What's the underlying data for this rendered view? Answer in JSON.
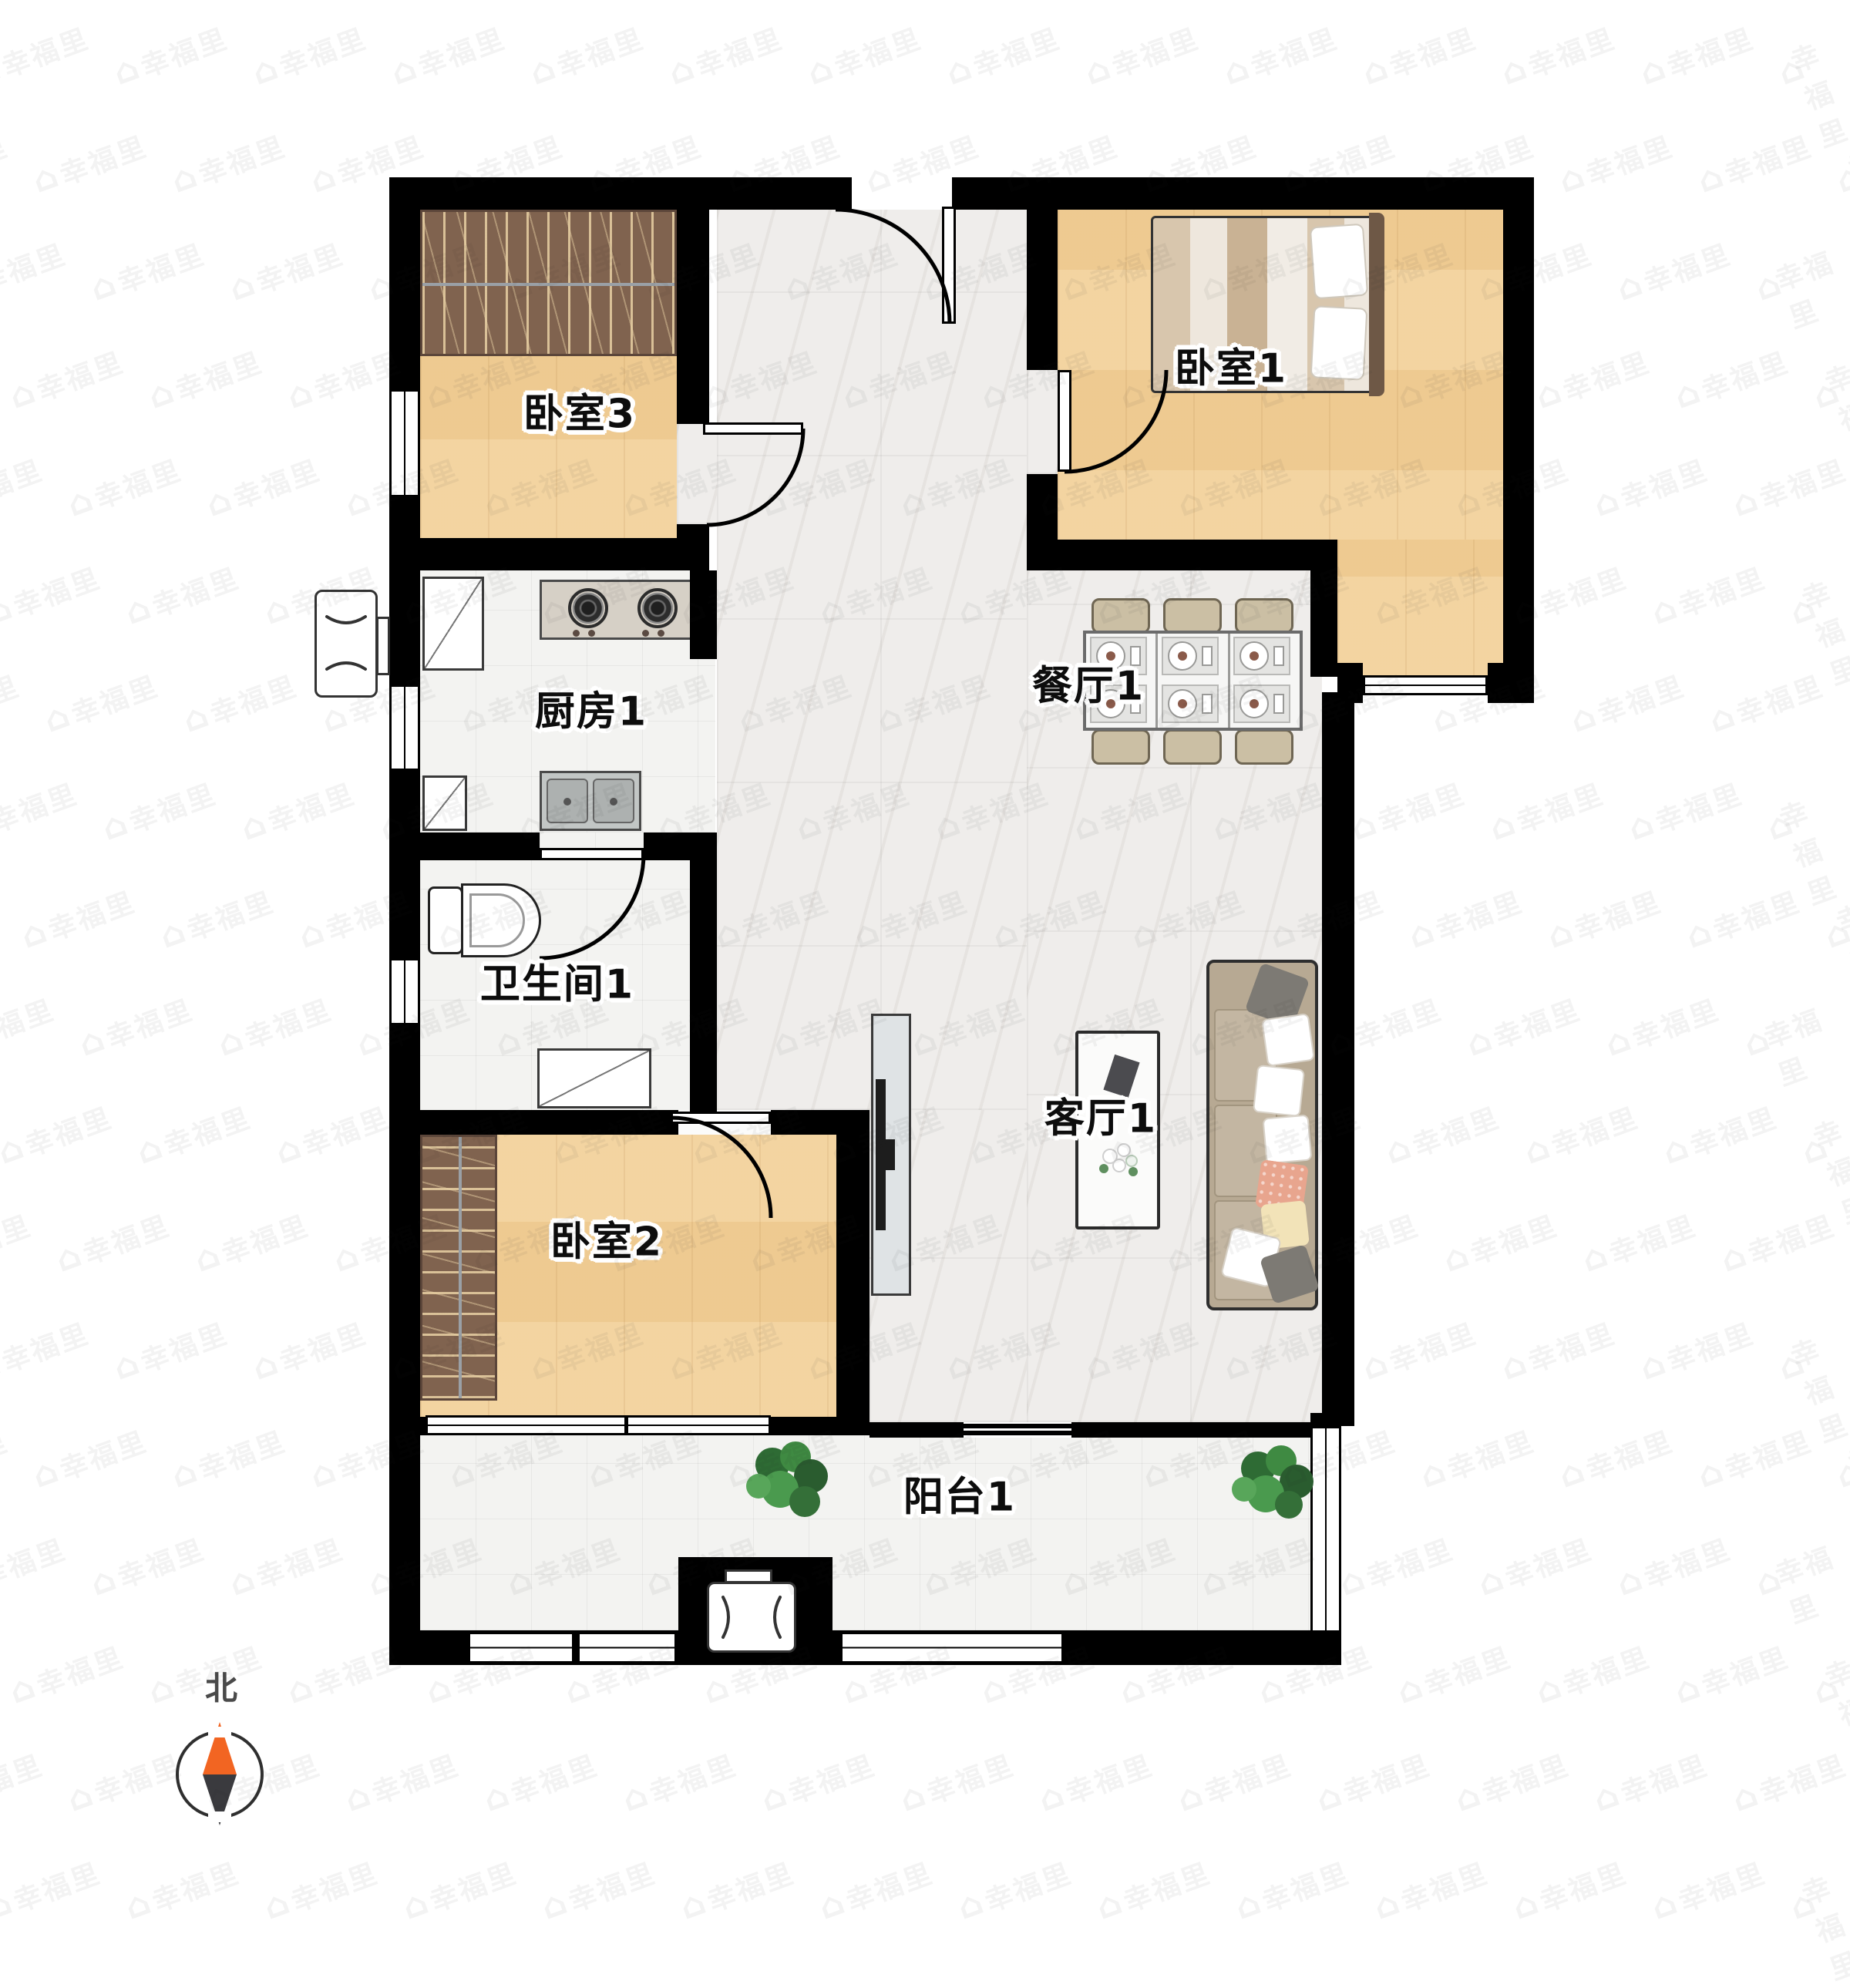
{
  "floorplan": {
    "title": "apartment-floor-plan",
    "rooms": {
      "bedroom3": "卧室3",
      "bedroom1": "卧室1",
      "kitchen": "厨房1",
      "dining": "餐厅1",
      "bathroom": "卫生间1",
      "bedroom2": "卧室2",
      "living": "客厅1",
      "balcony": "阳台1"
    },
    "compass": {
      "north_label": "北"
    },
    "watermark": {
      "text": "幸福里",
      "icon_glyph": "⌂"
    },
    "colors": {
      "wall": "#000000",
      "wood_floor": "#f2cf96",
      "marble_floor": "#efedeb",
      "tile_floor": "#f3f3f1",
      "wardrobe": "#80634f",
      "compass_north": "#f26522",
      "compass_south": "#3a3a3e",
      "sofa": "#b7a993",
      "plant": "#3f8a42"
    }
  }
}
